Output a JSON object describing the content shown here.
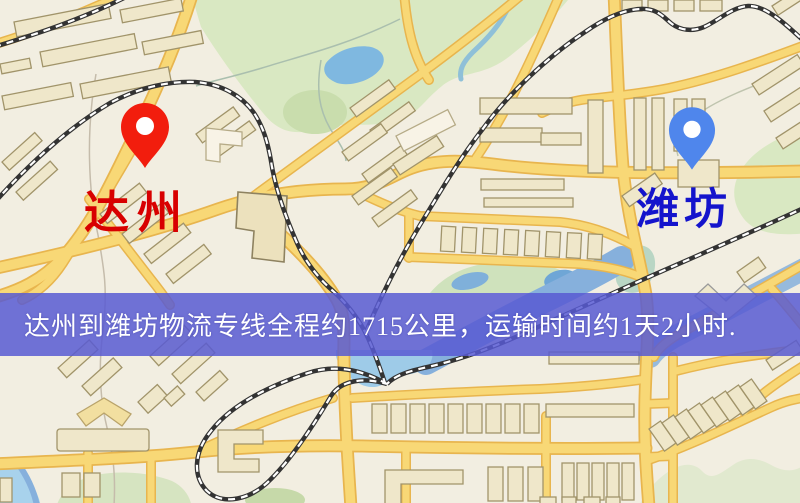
{
  "origin": {
    "label": "达州",
    "pin_color": "#f21d0d",
    "label_color": "#d80000"
  },
  "destination": {
    "label": "潍坊",
    "pin_color": "#4f86ec",
    "label_color": "#1414cc"
  },
  "banner": {
    "text": "达州到潍坊物流专线全程约1715公里，运输时间约1天2小时.",
    "bg_color": "#585ad2",
    "text_color": "#ffffff"
  },
  "map_colors": {
    "background": "#f2eee1",
    "road_fill": "#f8d876",
    "road_casing": "#e8b54e",
    "railway": "#333333",
    "railway_dash": "#ffffff",
    "water": "#86b0dc",
    "lake": "#7fb8e0",
    "park_green": "#d9e8c2",
    "building_fill": "#efe7ca",
    "building_stroke": "#a1946a"
  }
}
